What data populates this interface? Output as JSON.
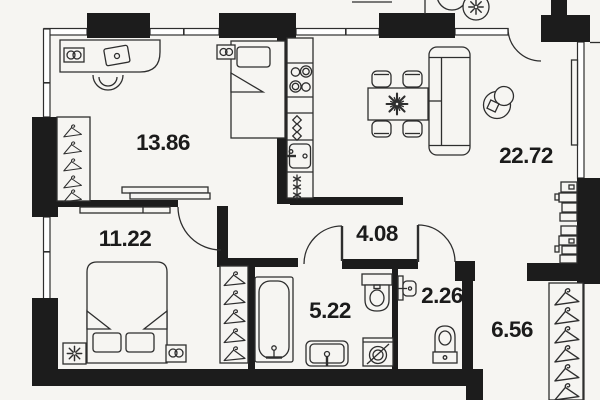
{
  "plan": {
    "rooms": [
      {
        "name": "room-13-86",
        "area": "13.86"
      },
      {
        "name": "living-22-72",
        "area": "22.72"
      },
      {
        "name": "bedroom-11-22",
        "area": "11.22"
      },
      {
        "name": "hall-4-08",
        "area": "4.08"
      },
      {
        "name": "bathroom-5-22",
        "area": "5.22"
      },
      {
        "name": "wc-2-26",
        "area": "2.26"
      },
      {
        "name": "entry-6-56",
        "area": "6.56"
      }
    ],
    "colors": {
      "wall": "#1c1c1c",
      "line": "#2e2e2e",
      "background": "#f6f5f2",
      "label": "#1b1b1b"
    },
    "icons": [
      "hanger-icon",
      "desk-icon",
      "laptop-icon",
      "office-chair-icon",
      "socket-icon",
      "single-bed-icon",
      "double-bed-icon",
      "wardrobe-icon",
      "shelf-icon",
      "flower-icon",
      "stove-icon",
      "kitchen-sink-icon",
      "freezer-icon",
      "dining-table-icon",
      "plant-icon",
      "chair-icon",
      "sofa-icon",
      "armchair-icon",
      "tv-icon",
      "bathtub-icon",
      "toilet-icon",
      "washing-machine-icon",
      "sink-icon",
      "door-arc-icon",
      "window-icon"
    ]
  }
}
